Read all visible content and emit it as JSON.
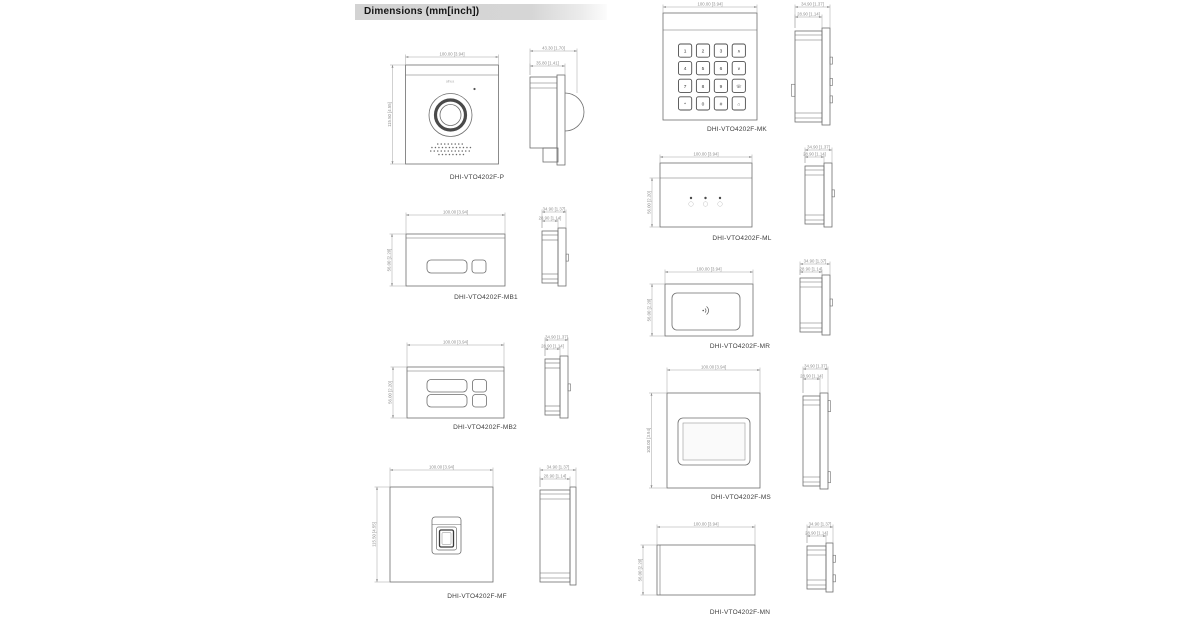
{
  "header": {
    "title": "Dimensions (mm[inch])"
  },
  "colors": {
    "line": "#6e6e6e",
    "dim_line": "#a3a3a3",
    "dim_text": "#8f8f8f",
    "label_text": "#3d3d3d",
    "header_bg": "#d6d6d6"
  },
  "keypad": {
    "rows": [
      [
        "1",
        "2",
        "3",
        "∧"
      ],
      [
        "4",
        "5",
        "6",
        "∨"
      ],
      [
        "7",
        "8",
        "9",
        "☏"
      ],
      [
        "*",
        "0",
        "#",
        "⌂"
      ]
    ]
  },
  "modules": [
    {
      "id": "p",
      "label": "DHI-VTO4202F-P",
      "logo": "alhua",
      "dims": {
        "width": "100.00 [3.94]",
        "height": "115.50 [4.55]",
        "depth_outer": "43.30 [1.70]",
        "depth_inner": "35.80 [1.41]"
      }
    },
    {
      "id": "mb1",
      "label": "DHI-VTO4202F-MB1",
      "dims": {
        "width": "100.00 [3.94]",
        "height": "56.00 [2.20]",
        "depth_outer": "34.90 [1.37]",
        "depth_inner": "28.90 [1.14]"
      }
    },
    {
      "id": "mb2",
      "label": "DHI-VTO4202F-MB2",
      "dims": {
        "width": "100.00 [3.94]",
        "height": "56.00 [2.20]",
        "depth_outer": "34.90 [1.37]",
        "depth_inner": "28.90 [1.14]"
      }
    },
    {
      "id": "mf",
      "label": "DHI-VTO4202F-MF",
      "dims": {
        "width": "100.00 [3.94]",
        "height": "115.50 [4.55]",
        "depth_outer": "34.90 [1.37]",
        "depth_inner": "28.90 [1.14]"
      }
    },
    {
      "id": "mk",
      "label": "DHI-VTO4202F-MK",
      "dims": {
        "width": "100.00 [3.94]",
        "depth_outer": "34.90 [1.37]",
        "depth_inner": "28.90 [1.14]"
      }
    },
    {
      "id": "ml",
      "label": "DHI-VTO4202F-ML",
      "dims": {
        "width": "100.00 [3.94]",
        "height": "56.00 [2.20]",
        "depth_outer": "34.90 [1.37]",
        "depth_inner": "28.90 [1.14]"
      }
    },
    {
      "id": "mr",
      "label": "DHI-VTO4202F-MR",
      "dims": {
        "width": "100.00 [3.94]",
        "height": "56.00 [2.20]",
        "depth_outer": "34.90 [1.37]",
        "depth_inner": "28.90 [1.14]"
      }
    },
    {
      "id": "ms",
      "label": "DHI-VTO4202F-MS",
      "dims": {
        "width": "100.00 [3.94]",
        "height": "100.00 [3.94]",
        "depth_outer": "34.90 [1.37]",
        "depth_inner": "28.90 [1.14]"
      }
    },
    {
      "id": "mn",
      "label": "DHI-VTO4202F-MN",
      "dims": {
        "width": "100.00 [3.94]",
        "height": "56.00 [2.20]",
        "depth_outer": "34.90 [1.37]",
        "depth_inner": "28.90 [1.14]"
      }
    }
  ]
}
